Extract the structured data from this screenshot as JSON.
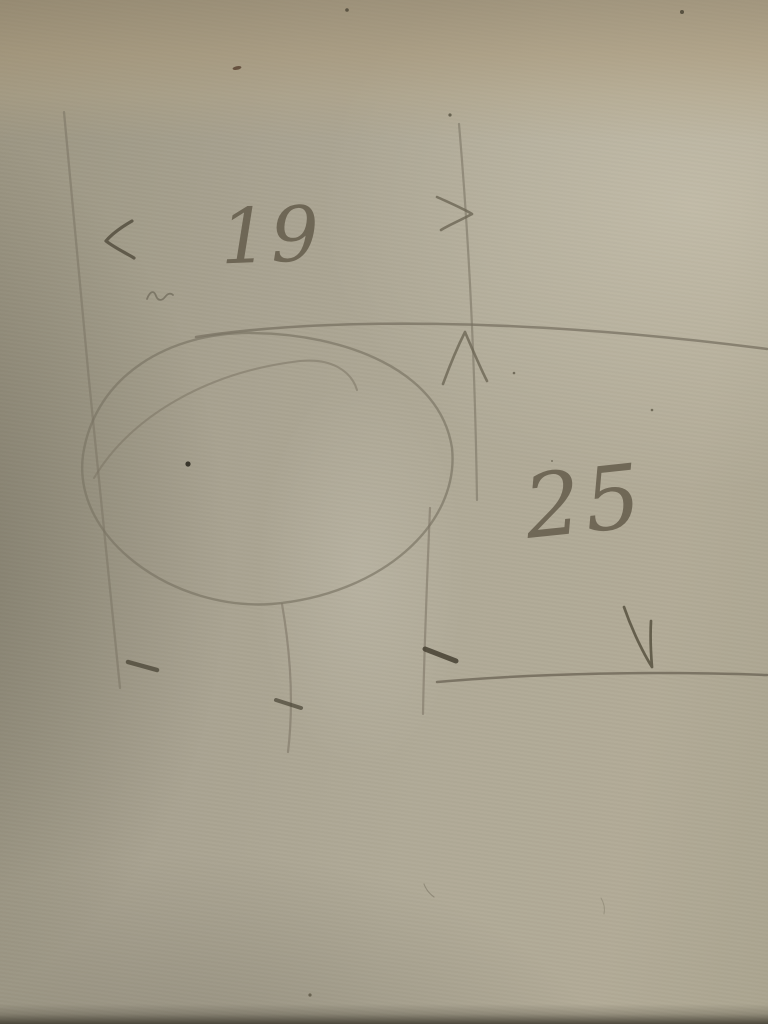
{
  "sketch": {
    "labels": {
      "width_dimension": "19",
      "height_dimension": "25"
    },
    "colors": {
      "paper_base": "#aba593",
      "paper_top_band": "#b3a385",
      "paper_left_shadow": "#8b8674",
      "paper_bottom_edge": "#5f5a4b",
      "pencil_light": "#7e7767",
      "pencil_dark": "#4e483a",
      "speck_brown": "#5a4432"
    }
  }
}
